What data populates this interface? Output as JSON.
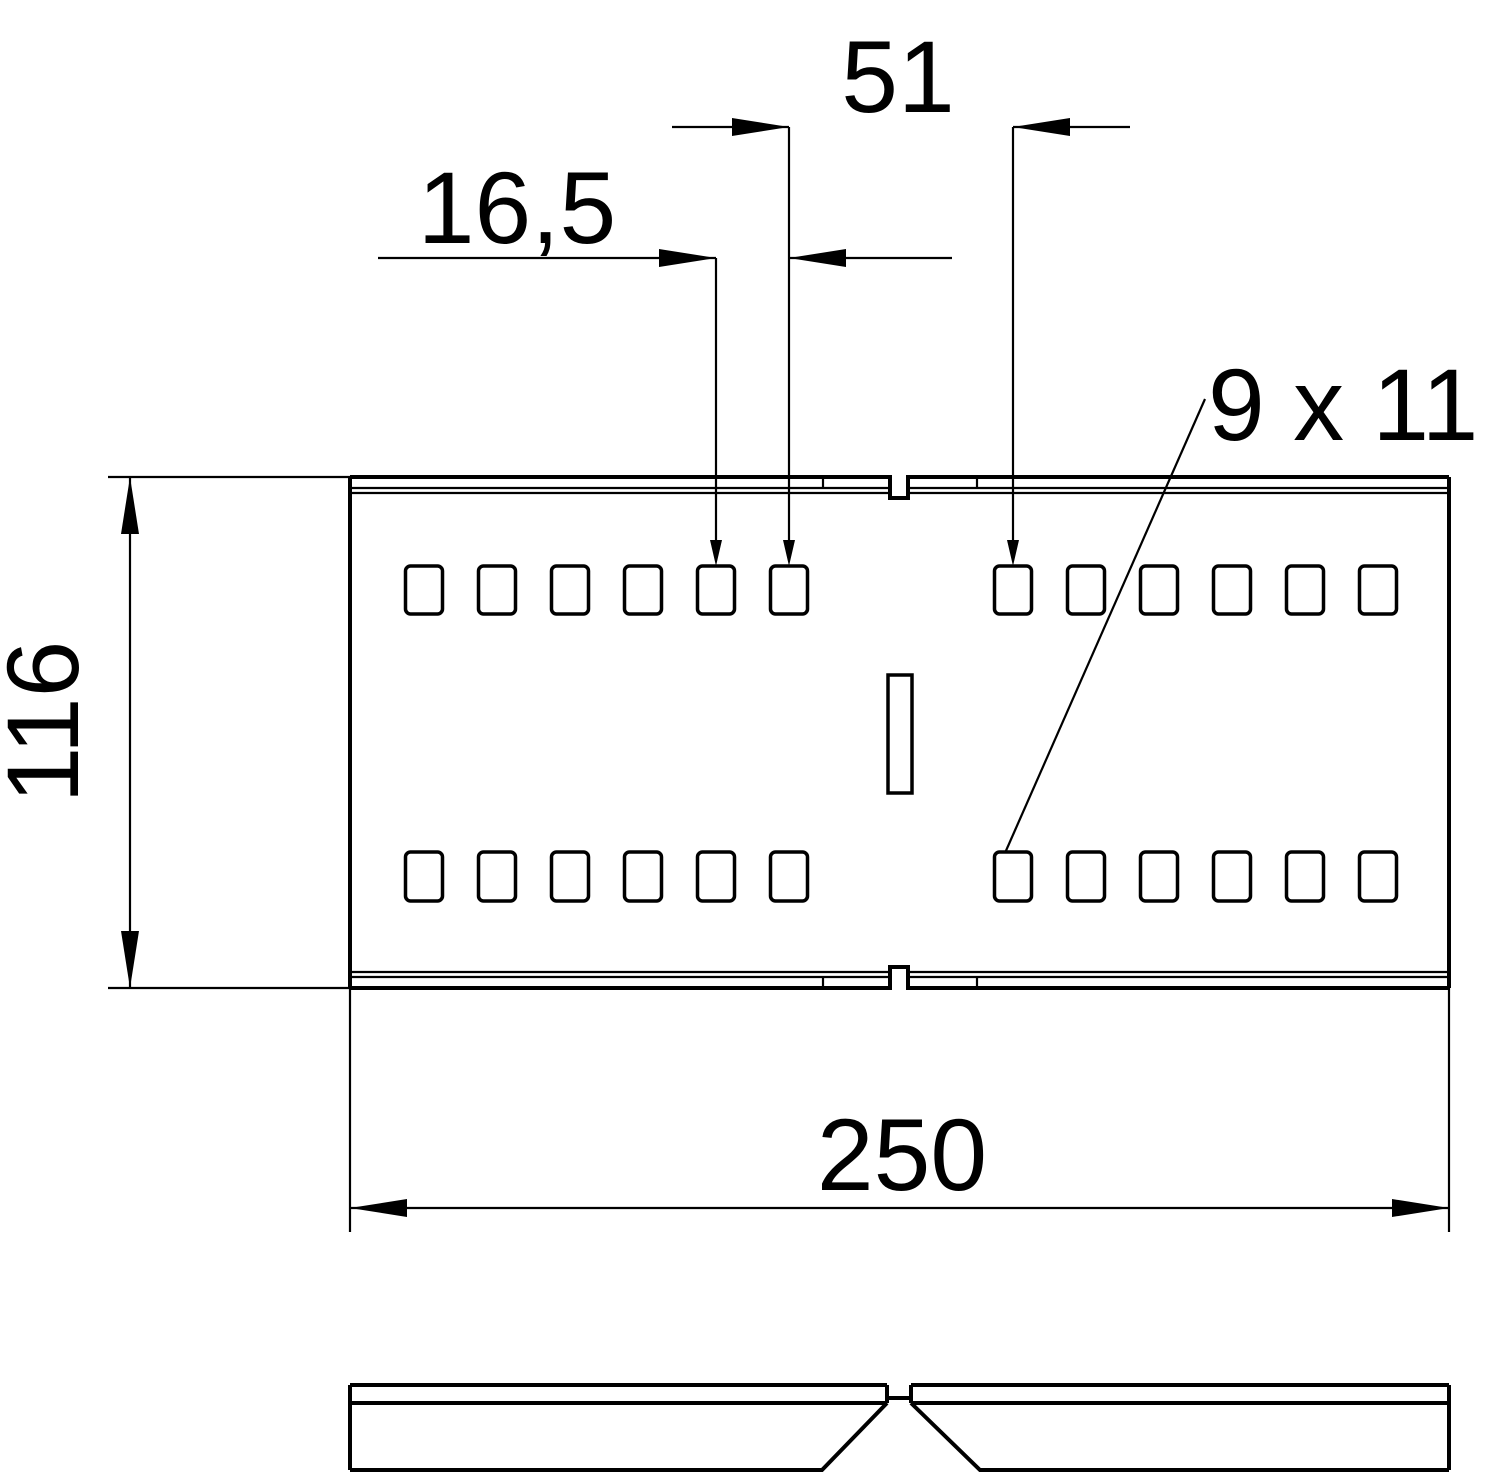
{
  "drawing": {
    "type": "technical dimension drawing, cable tray connector, two views",
    "background_color": "#ffffff",
    "line_color": "#000000",
    "views": [
      "top view with perforations",
      "side profile view"
    ],
    "part": {
      "hole_rows": 2,
      "holes_per_row_per_half": 6,
      "halves": 2,
      "center_slot": 1
    },
    "dimensions": {
      "gap_between_halves": "51",
      "hole_pitch": "16,5",
      "hole_size": "9 x 11",
      "overall_width": "116",
      "overall_length": "250"
    }
  }
}
